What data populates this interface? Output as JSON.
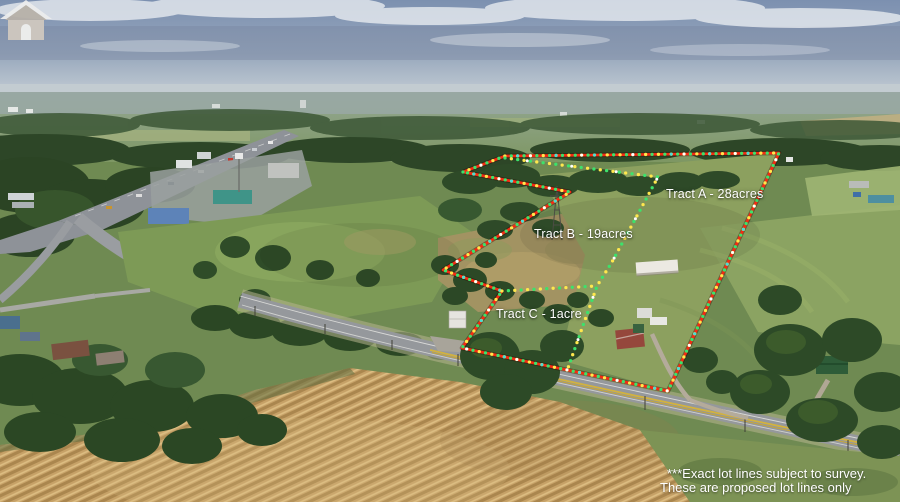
{
  "scene": {
    "alt": "Aerial drone photo of rural acreage for sale beside a highway interchange and two-lane road, with proposed lot lines drawn over the photo"
  },
  "tracts": [
    {
      "name": "Tract A",
      "acreage": "28acres",
      "label": "Tract A - 28acres"
    },
    {
      "name": "Tract B",
      "acreage": "19acres",
      "label": "Tract B - 19acres"
    },
    {
      "name": "Tract C",
      "acreage": "1acre",
      "label": "Tract C - 1acre"
    }
  ],
  "disclaimer": {
    "line1": "***Exact lot lines subject to survey.",
    "line2": "These are proposed lot lines only"
  },
  "watermark": {
    "icon": "house-logo"
  },
  "overlay_colors": {
    "boundary_red": "#f52a12",
    "dot_green": "#3de26b",
    "dot_yellow": "#ffe84d",
    "dot_cyan": "#4adcd6",
    "dot_white": "#ffffff"
  },
  "boundaries": {
    "perimeter": "463,172 505,156 779,153 668,391 462,348 502,291 443,270 570,192 463,172",
    "divider_ab": "505,158 658,177 612,262 597,286 568,368",
    "divider_c": "502,291 597,286"
  }
}
